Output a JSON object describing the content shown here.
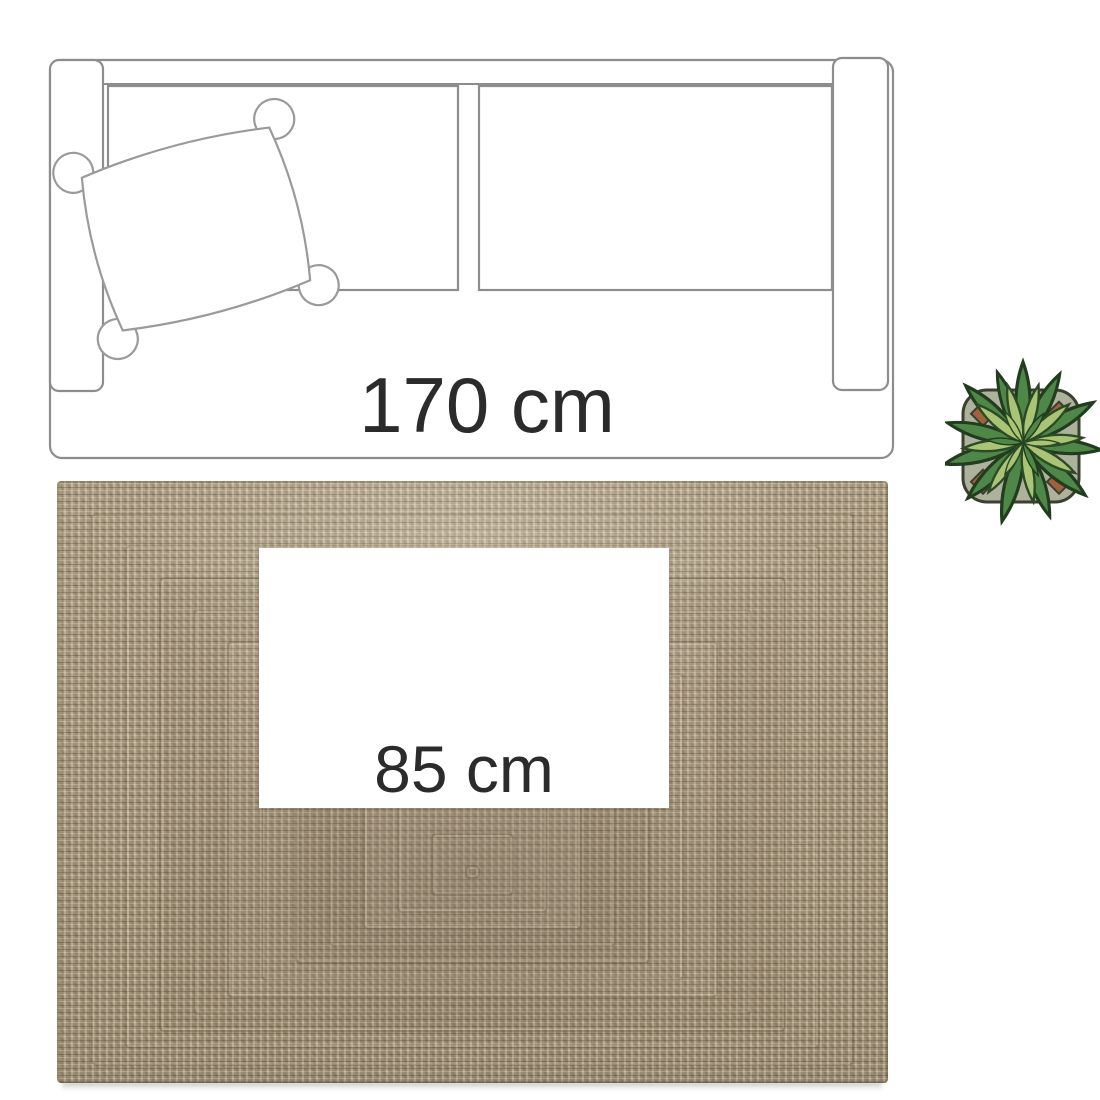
{
  "labels": {
    "sofa_length": "170 cm",
    "rug_width": "85 cm"
  },
  "icons": {
    "sofa": "sofa-top-view-outline",
    "pillow": "pillow-outline",
    "rug": "braided-jute-rug",
    "plant": "potted-plant-top-view"
  },
  "colors": {
    "outline_gray": "#8d8d8d",
    "text_dark": "#2b2b2b",
    "rug_base": "#a59478",
    "rug_highlight": "#d6c9ad",
    "rug_shadow_tone": "#5f5340",
    "leaf_dark": "#4f8749",
    "leaf_light": "#a9c474",
    "pot": "#aeb29c",
    "soil": "#a2603c"
  }
}
